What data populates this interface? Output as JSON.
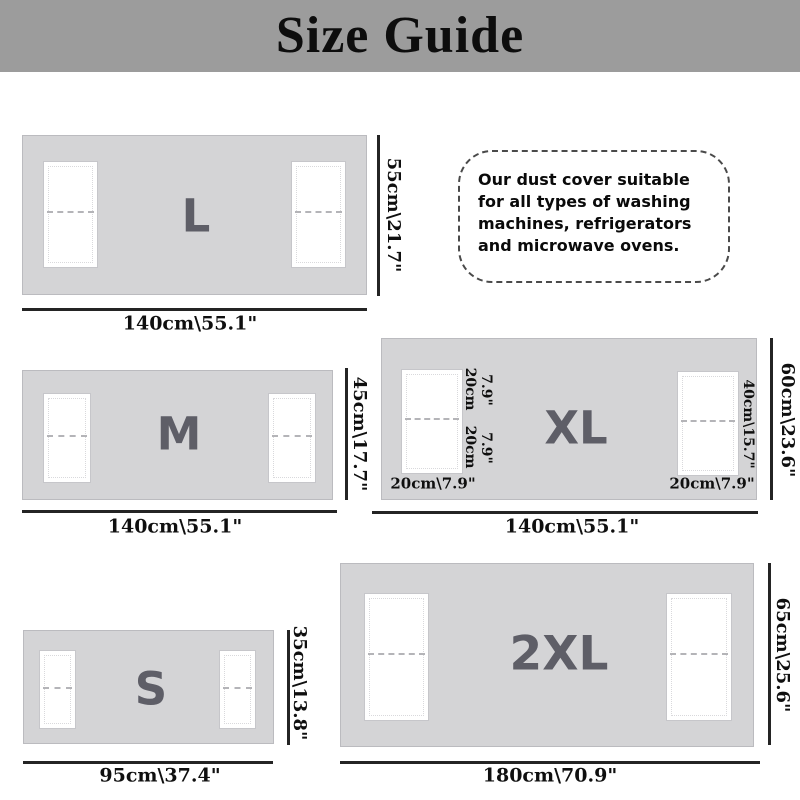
{
  "title": "Size Guide",
  "note": {
    "lines": [
      "Our dust cover suitable",
      "for all types of washing",
      "machines, refrigerators",
      "and microwave ovens."
    ]
  },
  "sizes": {
    "l": {
      "label": "L",
      "width": "140cm\\55.1\"",
      "height": "55cm\\21.7\""
    },
    "m": {
      "label": "M",
      "width": "140cm\\55.1\"",
      "height": "45cm\\17.7\""
    },
    "xl": {
      "label": "XL",
      "width": "140cm\\55.1\"",
      "height": "60cm\\23.6\"",
      "left_pocket_top_cm": "20cm",
      "left_pocket_top_in": "7.9\"",
      "left_pocket_bottom_cm": "20cm",
      "left_pocket_bottom_in": "7.9\"",
      "left_pocket_width": "20cm\\7.9\"",
      "right_pocket_width": "20cm\\7.9\"",
      "right_pocket_height": "40cm\\15.7\""
    },
    "s": {
      "label": "S",
      "width": "95cm\\37.4\"",
      "height": "35cm\\13.8\""
    },
    "xxl": {
      "label": "2XL",
      "width": "180cm\\70.9\"",
      "height": "65cm\\25.6\""
    }
  },
  "colors": {
    "banner_bg": "#9c9c9c",
    "cover_fill": "#d4d4d6",
    "cover_border": "#bbbbbf",
    "pocket_fill": "#ffffff",
    "size_label": "#5e5e67",
    "dim_line": "#242424",
    "text": "#0d0d0d"
  }
}
